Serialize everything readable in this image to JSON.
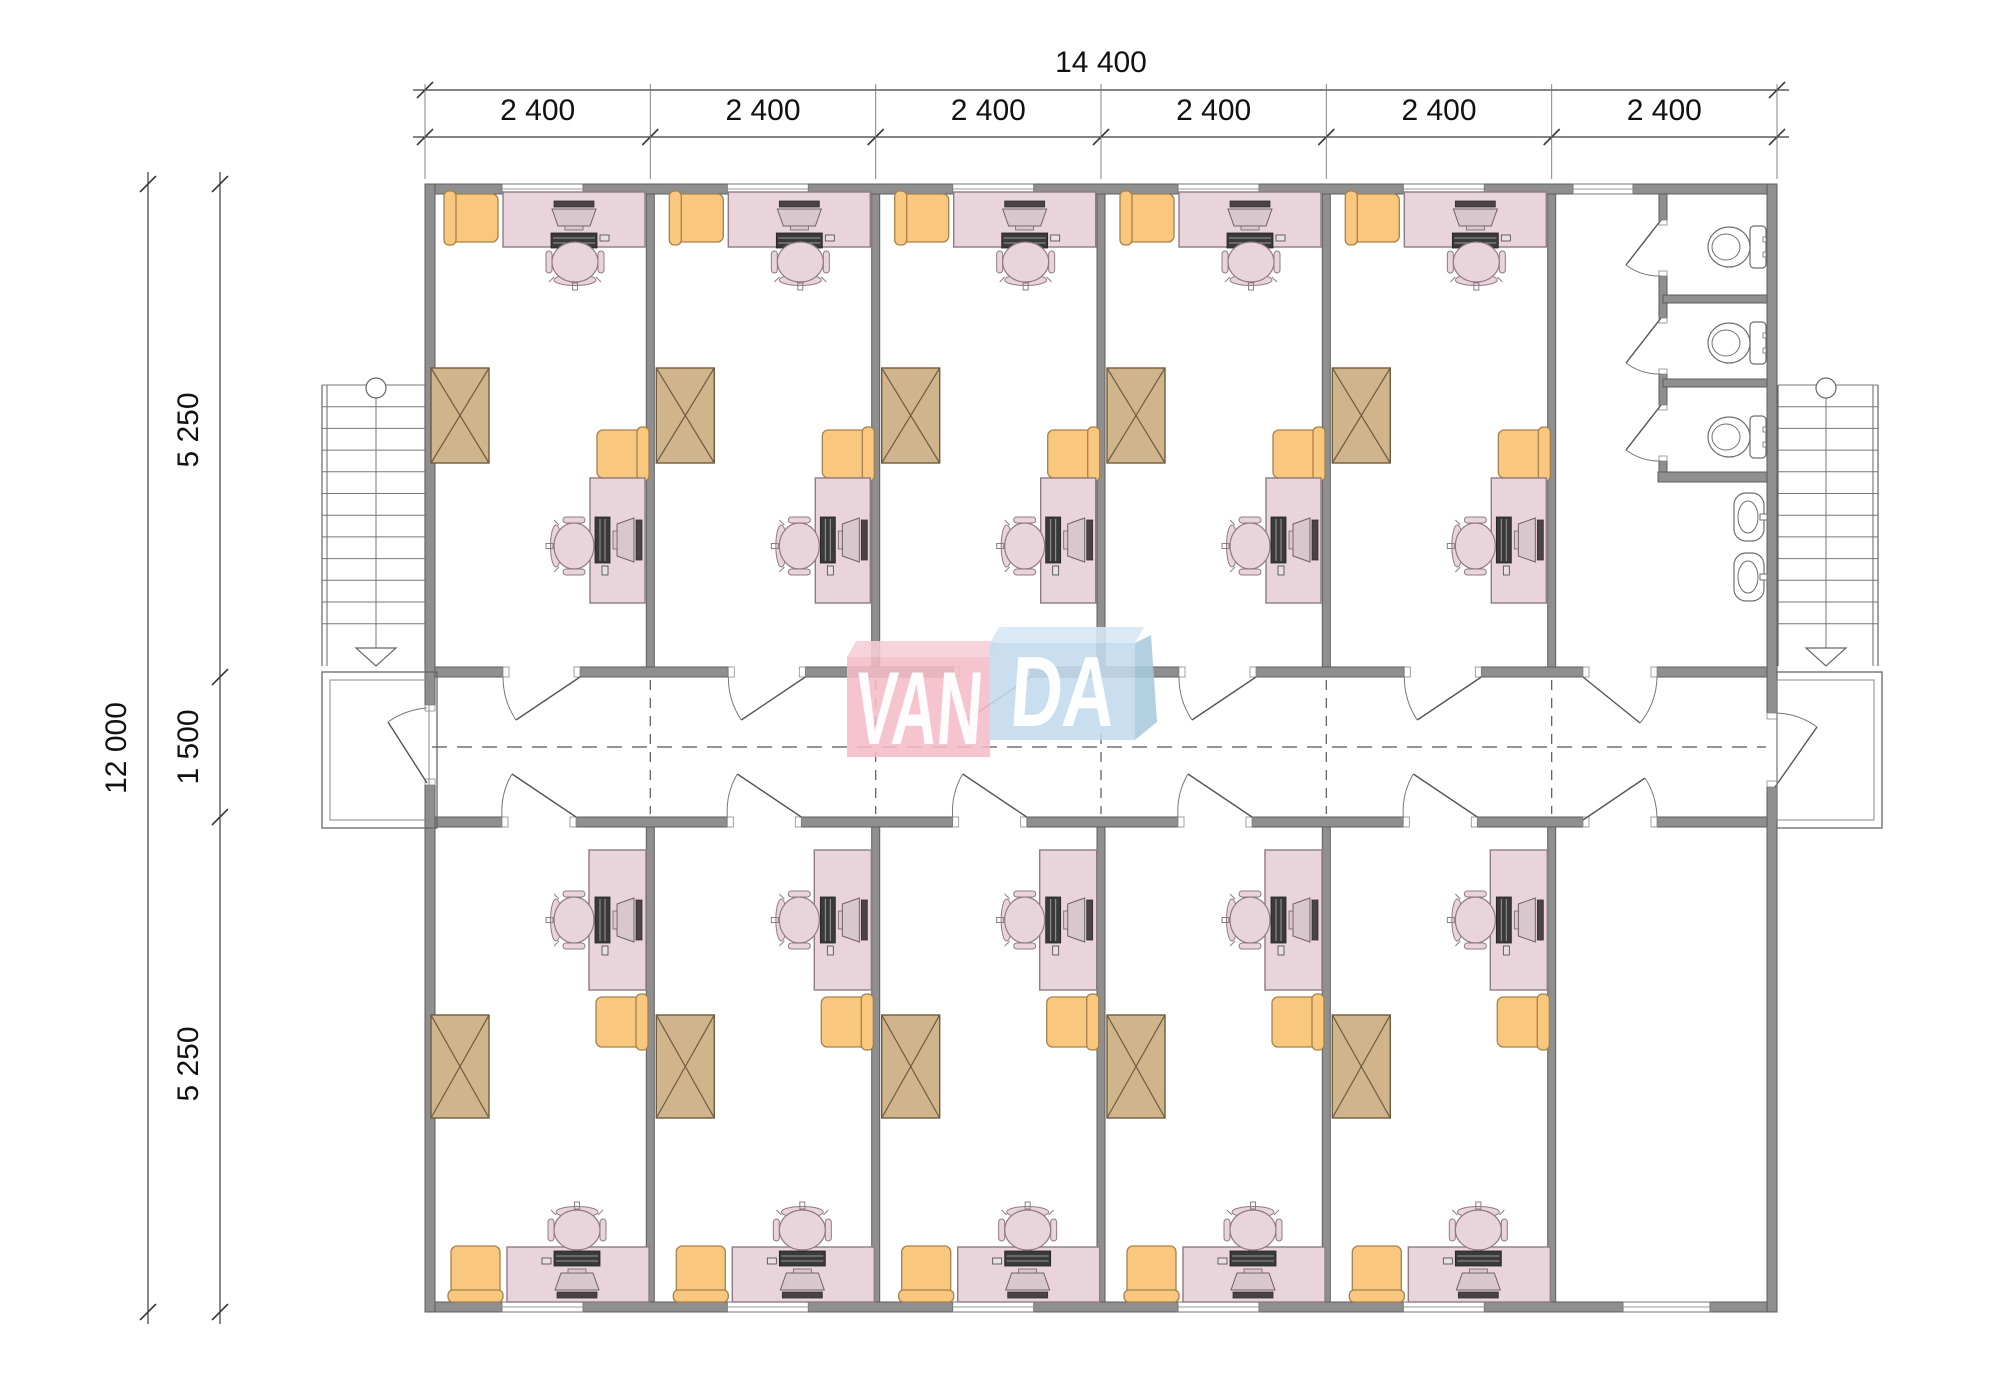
{
  "drawing_title": "office-container-floor-plan",
  "dimensions": {
    "top_total": "14 400",
    "top_segments": [
      "2 400",
      "2 400",
      "2 400",
      "2 400",
      "2 400",
      "2 400"
    ],
    "left_total": "12 000",
    "left_segments": [
      "5 250",
      "1 500",
      "5 250"
    ]
  },
  "logo": {
    "left_text": "VAN",
    "right_text": "DA",
    "pink": "#f4bcc8",
    "pink_top": "#f7cfd7",
    "blue": "#c2dbee",
    "blue_top": "#d8e8f5",
    "blue_side": "#a9cadf",
    "text_color": "#ffffff"
  },
  "colors": {
    "wall": "#8f8f8f",
    "wall_edge": "#5e5e5e",
    "desk": "#e9d4db",
    "desk_edge": "#8f7b84",
    "monitor_body": "#d8c8cd",
    "monitor_dark": "#4a4245",
    "keyboard": "#3a3a3a",
    "orange": "#f9c87e",
    "orange_edge": "#a5814c",
    "cabinet": "#cfb48c",
    "cabinet_edge": "#6f5c3e",
    "fixture_edge": "#6f6f6f",
    "thin_line": "#666666",
    "dash_line": "#555555",
    "dim_line": "#3a3a3a",
    "dim_text": "#111111"
  }
}
